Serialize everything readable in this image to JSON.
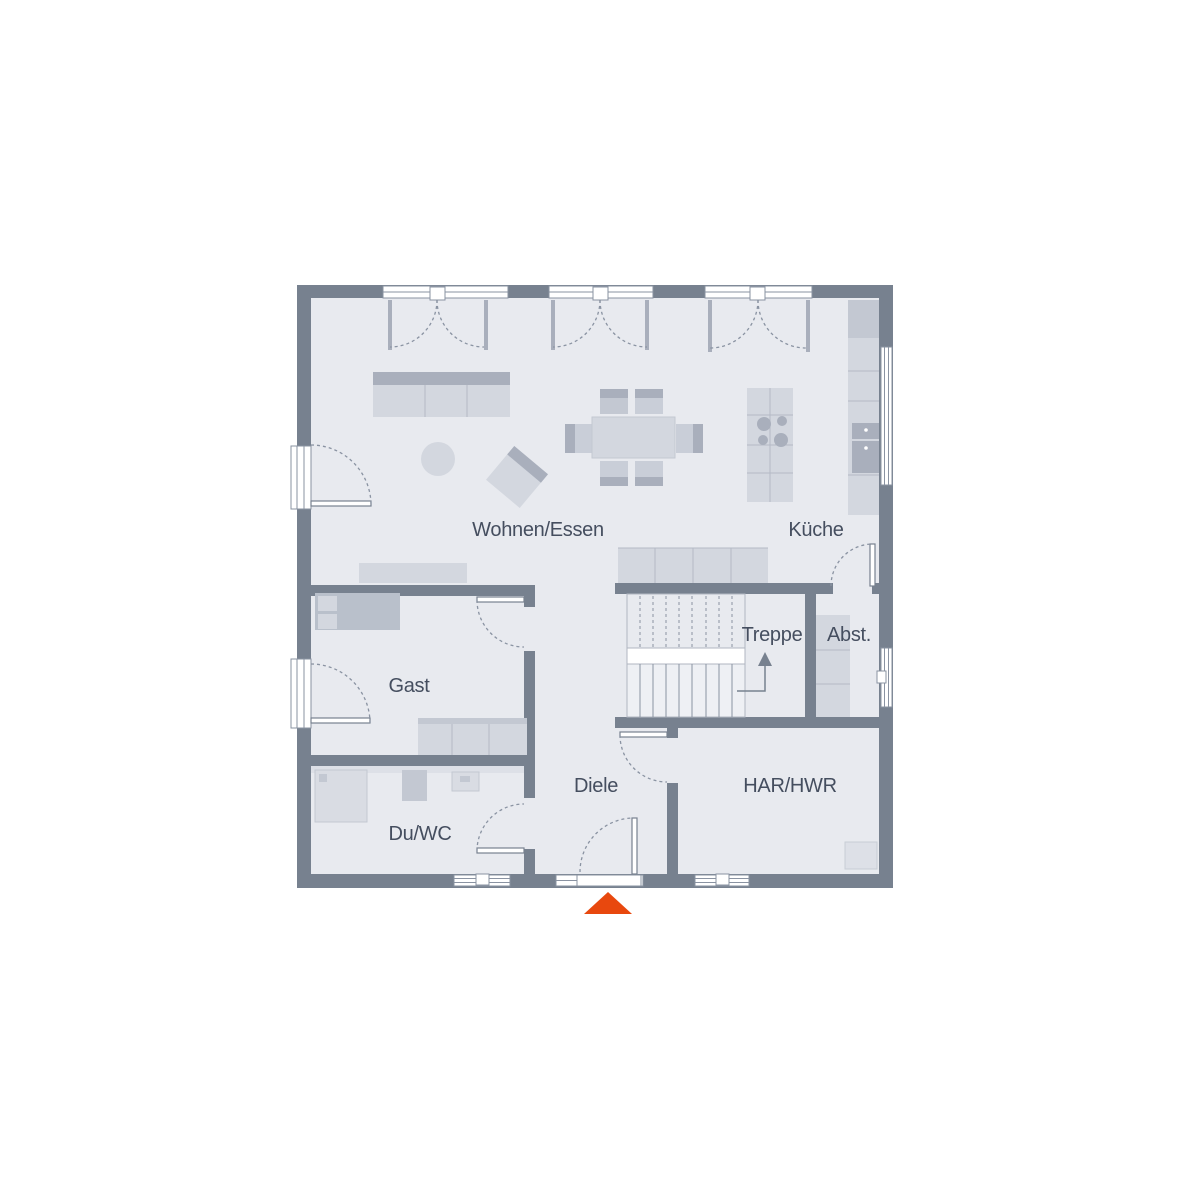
{
  "floorplan": {
    "type": "residential-ground-floor-plan",
    "rooms": [
      {
        "id": "wohnen-essen",
        "label": "Wohnen/Essen"
      },
      {
        "id": "kueche",
        "label": "Küche"
      },
      {
        "id": "gast",
        "label": "Gast"
      },
      {
        "id": "treppe",
        "label": "Treppe"
      },
      {
        "id": "abst",
        "label": "Abst."
      },
      {
        "id": "diele",
        "label": "Diele"
      },
      {
        "id": "har-hwr",
        "label": "HAR/HWR"
      },
      {
        "id": "du-wc",
        "label": "Du/WC"
      }
    ],
    "colors": {
      "background": "#ffffff",
      "wall": "#77818f",
      "floor": "#e8eaef",
      "furniture_light": "#d3d7df",
      "furniture_medium": "#c3c8d2",
      "furniture_dark": "#a9afbc",
      "label_text": "#454e5f",
      "entrance_marker": "#e8480e"
    },
    "icons": [
      {
        "name": "entrance-arrow",
        "shape": "triangle-up",
        "color": "#e8480e"
      },
      {
        "name": "stair-direction-arrow",
        "meaning": "stairs up"
      }
    ]
  }
}
